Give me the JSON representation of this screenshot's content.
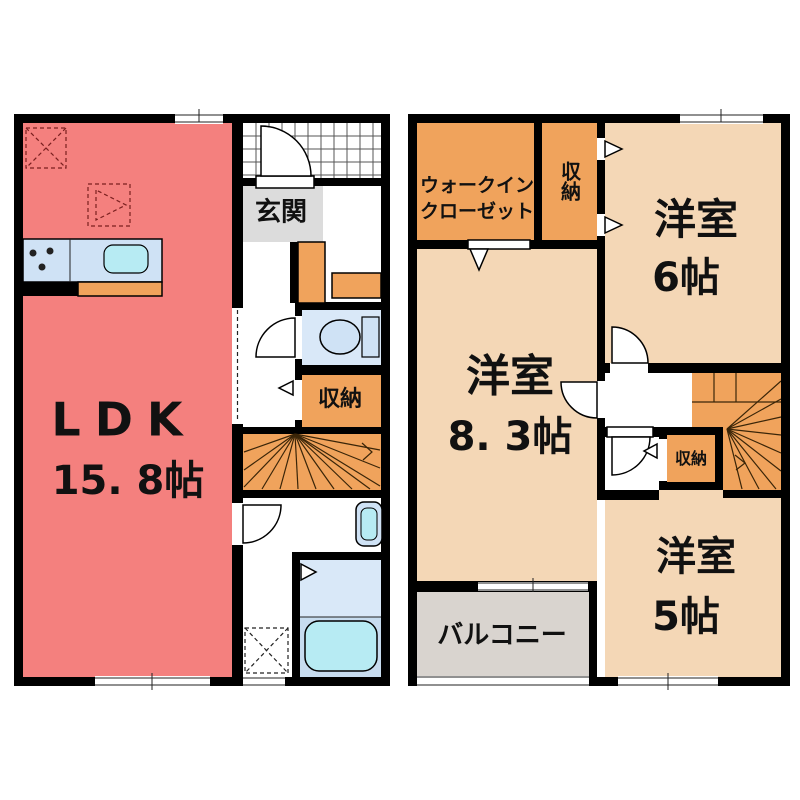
{
  "title": "2-story floor plan",
  "colors": {
    "wall": "#000000",
    "ldk_fill": "#F4807E",
    "storage_orange": "#F0A35C",
    "room_peach": "#F4D7B6",
    "genkan_gray": "#DCDCDC",
    "balcony_gray": "#D9D4CF",
    "fixture_blue": "#CFE2F5",
    "bath_blue": "#D9E8F8",
    "water_cyan": "#B7EBF3"
  },
  "floor1": {
    "genkan": "玄関",
    "closet": "収納",
    "ldk_name": "LDK",
    "ldk_size": "15. 8帖"
  },
  "floor2": {
    "wic_line1": "ウォークイン",
    "wic_line2": "クローゼット",
    "closet_top": "収納",
    "room6_name": "洋室",
    "room6_size": "6帖",
    "room83_name": "洋室",
    "room83_size": "8. 3帖",
    "closet_mid": "収納",
    "room5_name": "洋室",
    "room5_size": "5帖",
    "balcony": "バルコニー"
  }
}
